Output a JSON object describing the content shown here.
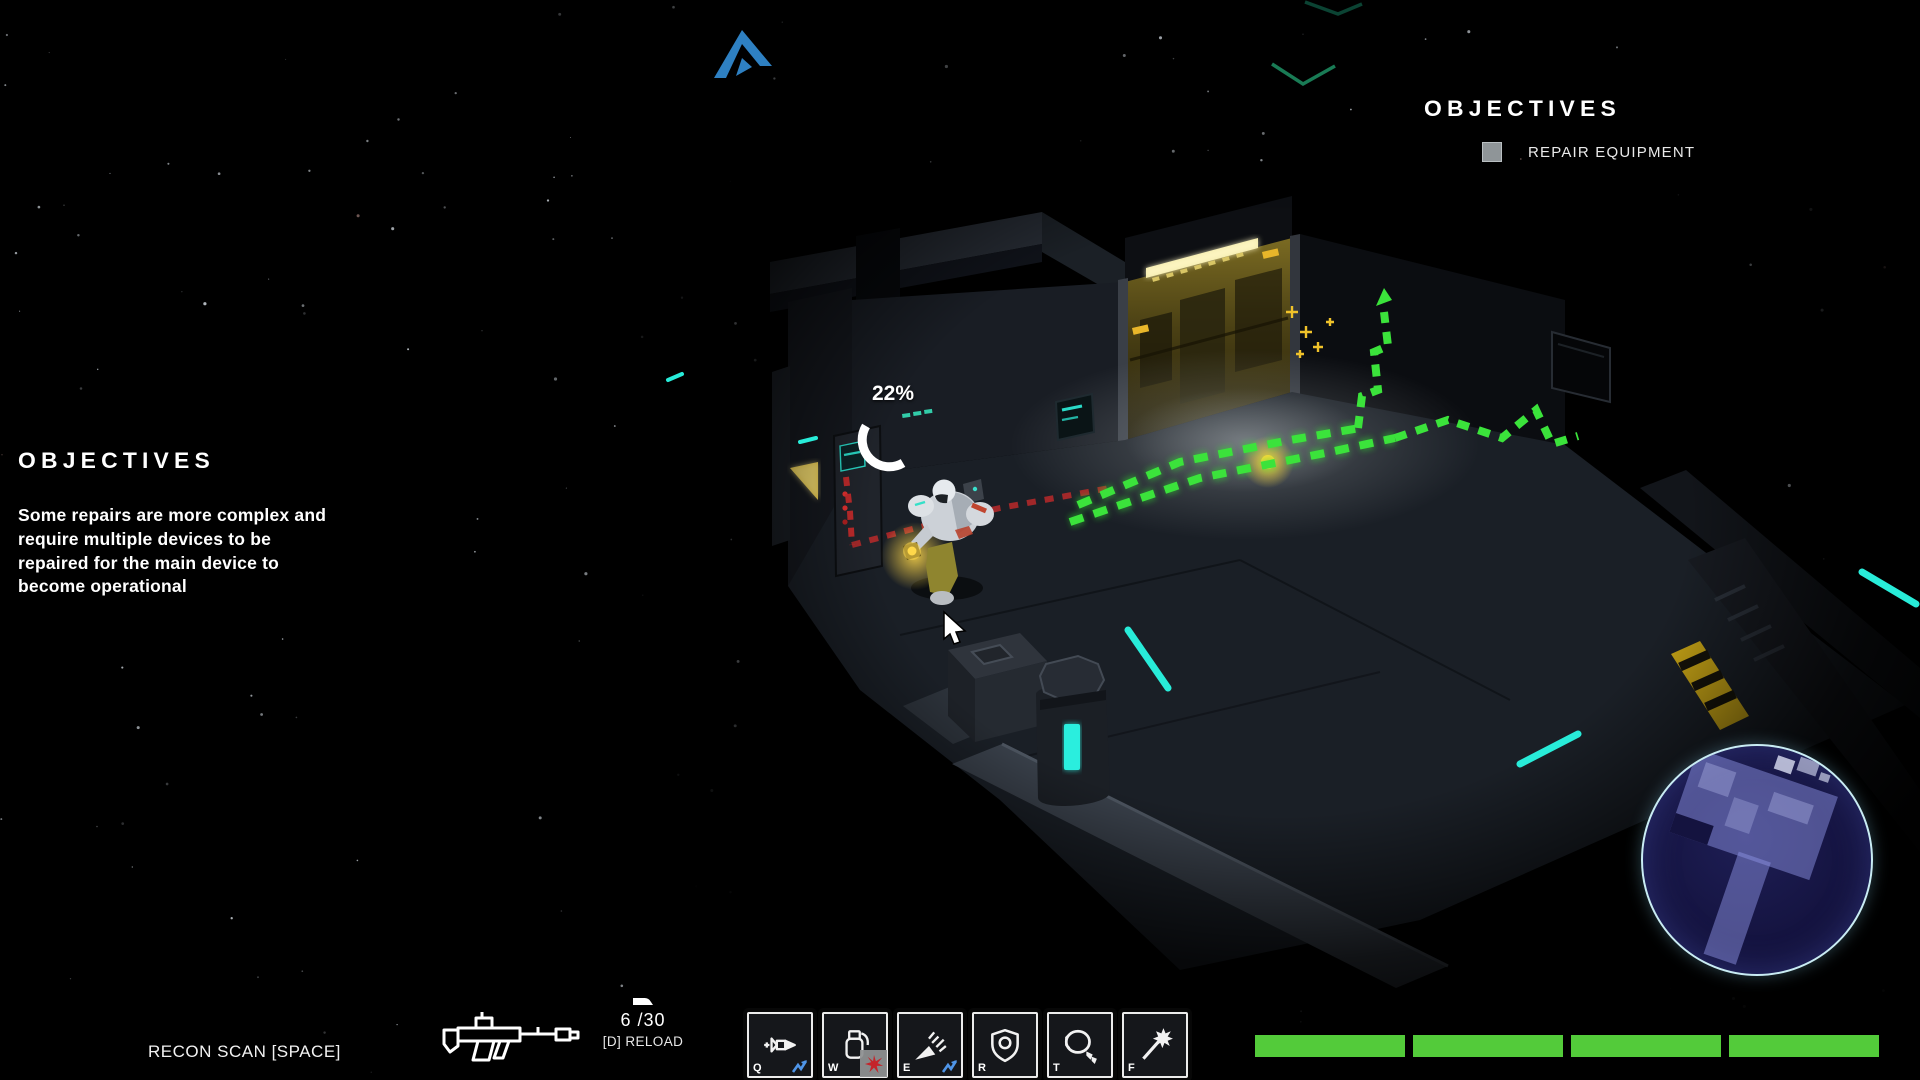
{
  "colors": {
    "path_green": "#3be33b",
    "path_red": "#cf2b2b",
    "accent_cyan": "#28ecd9",
    "bar_green": "#53cb3a",
    "waypoint_blue": "#2e80c2",
    "badge_blue": "#4f95e8",
    "badge_red": "#c5242a",
    "minimap_border": "#c9ecf4",
    "door_light": "#f2e9a8"
  },
  "objectives_right": {
    "title": "OBJECTIVES",
    "items": [
      {
        "label": "REPAIR EQUIPMENT",
        "completed": false
      }
    ]
  },
  "objectives_left": {
    "title": "OBJECTIVES",
    "description": "Some repairs are more complex and\nrequire multiple devices to be\nrepaired for the main device to\nbecome operational"
  },
  "repair_progress": {
    "value": "22%"
  },
  "recon_scan": {
    "label": "RECON SCAN [SPACE]"
  },
  "weapon": {
    "ammo": "6 /30",
    "reload_hint": "[D] RELOAD"
  },
  "hotbar": {
    "slots": [
      {
        "key": "Q",
        "icon": "dart-rocket-icon",
        "badge": "energy-zigzag-icon"
      },
      {
        "key": "W",
        "icon": "grenade-icon",
        "badge": "red-burst-icon"
      },
      {
        "key": "E",
        "icon": "impact-burst-icon",
        "badge": "energy-zigzag-icon"
      },
      {
        "key": "R",
        "icon": "shield-icon",
        "badge": null
      },
      {
        "key": "T",
        "icon": "orbital-drone-icon",
        "badge": null
      },
      {
        "key": "F",
        "icon": "repair-wand-icon",
        "badge": null
      }
    ]
  },
  "status_bars": {
    "segments": 4,
    "fill_percent": 100
  },
  "icons": {
    "waypoint": "waypoint-arrow-icon",
    "objective_checkbox": "checkbox-icon",
    "weapon": "rifle-icon",
    "magazine": "ammo-magazine-icon",
    "cursor": "mouse-cursor-icon"
  }
}
